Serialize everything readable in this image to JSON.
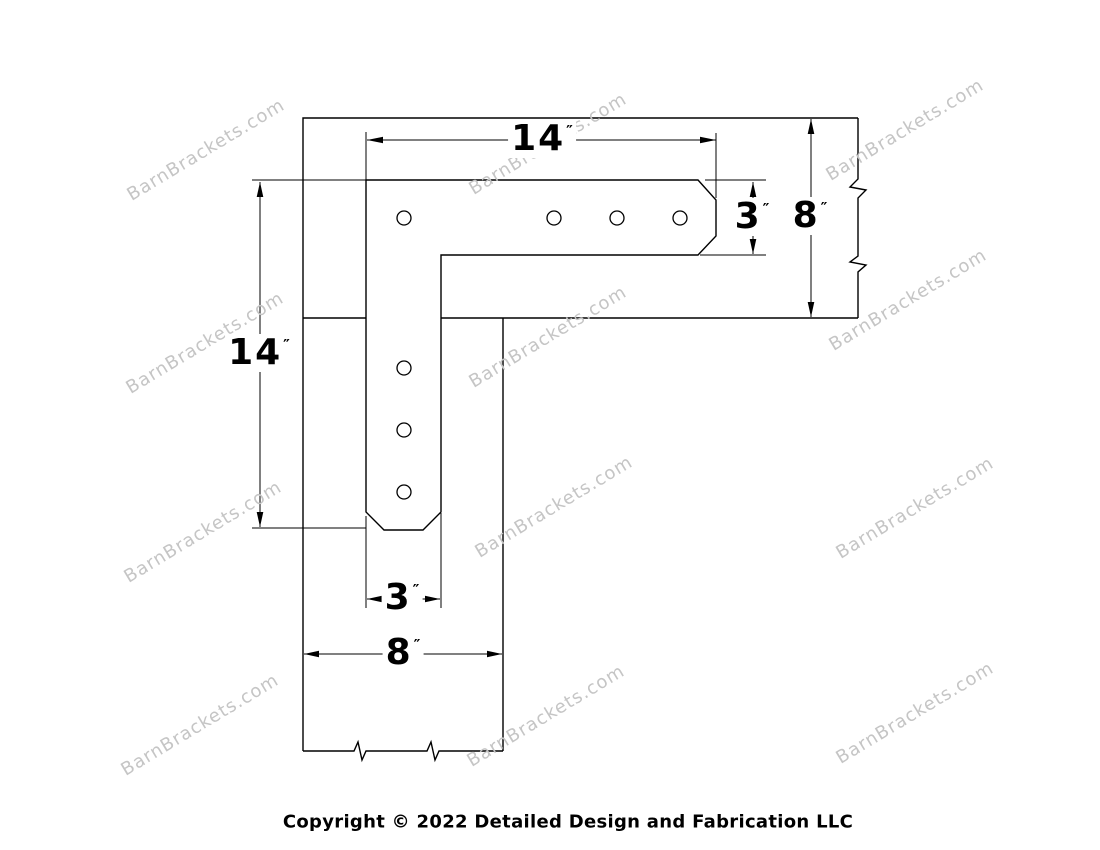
{
  "watermark": {
    "text": "BarnBrackets.com",
    "color": "#c5c5c5",
    "angle_deg": -31,
    "positions": [
      [
        206,
        150
      ],
      [
        548,
        144
      ],
      [
        905,
        130
      ],
      [
        205,
        343
      ],
      [
        548,
        337
      ],
      [
        908,
        300
      ],
      [
        203,
        532
      ],
      [
        554,
        507
      ],
      [
        915,
        508
      ],
      [
        200,
        725
      ],
      [
        546,
        716
      ],
      [
        915,
        713
      ]
    ]
  },
  "drawing": {
    "dimensions": {
      "top_width": {
        "value": "14",
        "unit": "″"
      },
      "right_arm_depth": {
        "value": "3",
        "unit": "″"
      },
      "right_beam_depth": {
        "value": "8",
        "unit": "″"
      },
      "left_height": {
        "value": "14",
        "unit": "″"
      },
      "bottom_arm_width": {
        "value": "3",
        "unit": "″"
      },
      "bottom_beam_width": {
        "value": "8",
        "unit": "″"
      }
    }
  },
  "footer": {
    "copyright": "Copyright © 2022 Detailed Design and Fabrication LLC"
  }
}
